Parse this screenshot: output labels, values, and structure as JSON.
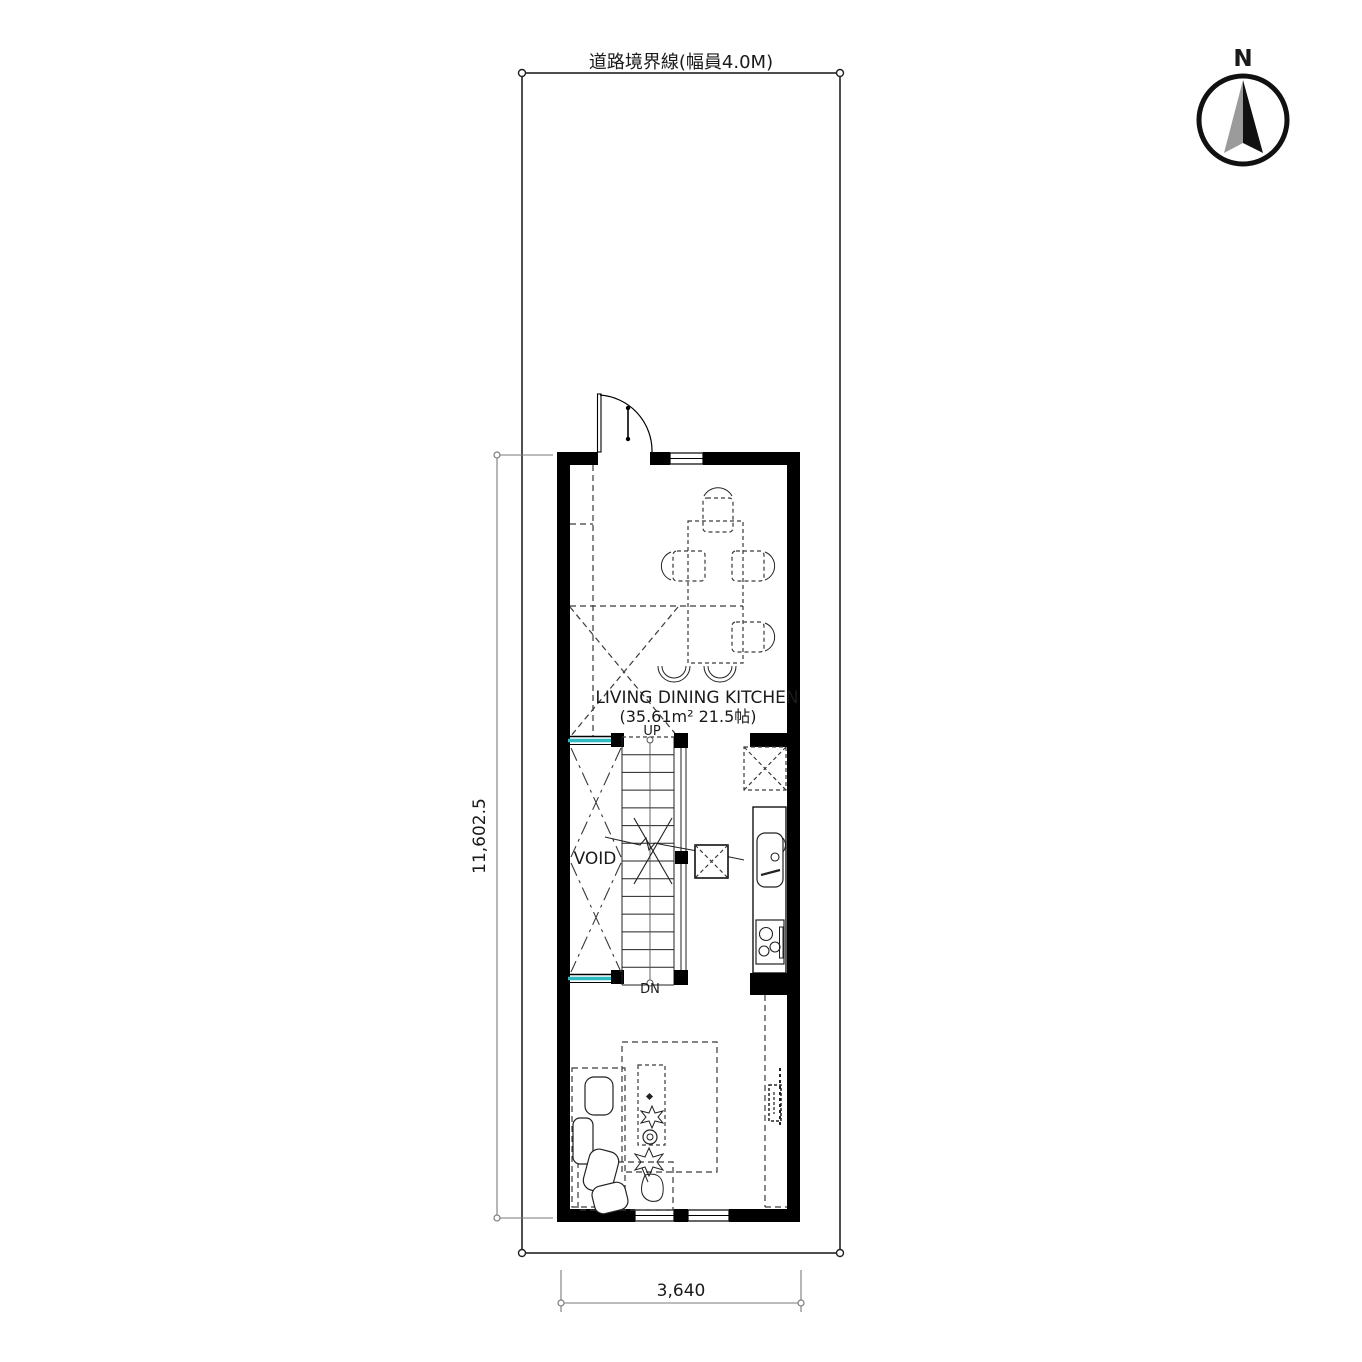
{
  "drawing": {
    "type": "floor-plan",
    "site": {
      "road_boundary_label": "道路境界線(幅員4.0M)"
    },
    "compass": {
      "north_label": "N"
    },
    "rooms": {
      "ldk": {
        "name": "LIVING DINING KITCHEN",
        "area": "(35.61m² 21.5帖)"
      },
      "void": {
        "name": "VOID"
      }
    },
    "stairs": {
      "up_label": "UP",
      "down_label": "DN"
    },
    "dimensions": {
      "site_depth": "11,602.5",
      "plan_width": "3,640"
    },
    "colors": {
      "wall": "#000000",
      "glass_accent": "#2fb9c0",
      "dimension_line": "#7a7a7a",
      "dashed_line": "#3a3a3a",
      "compass_gray": "#9b9b9b"
    }
  }
}
